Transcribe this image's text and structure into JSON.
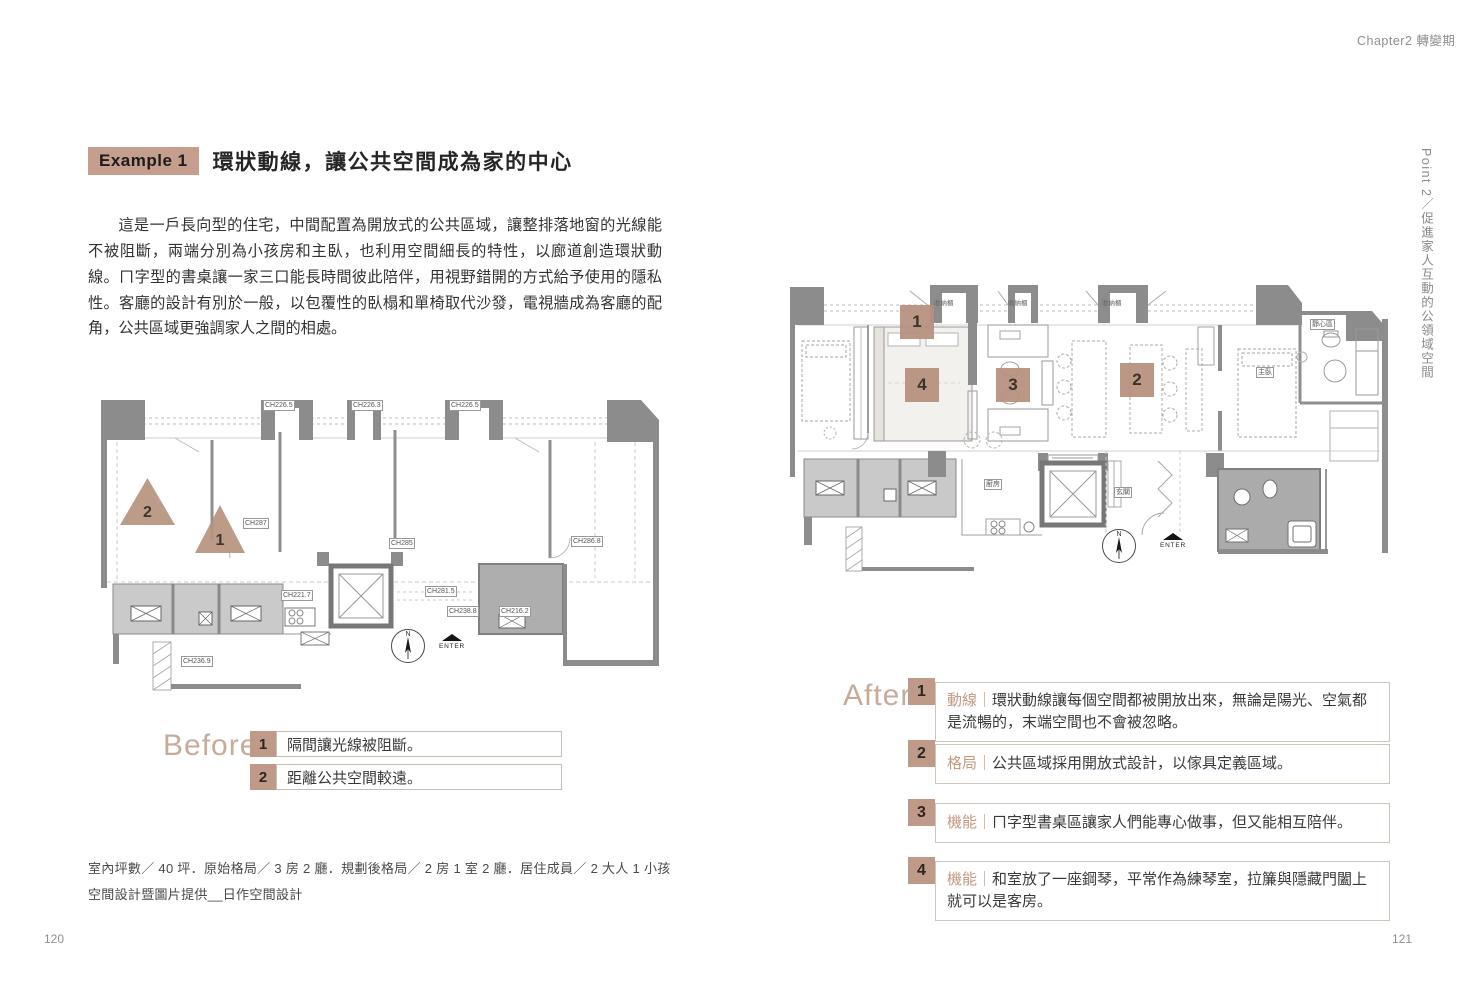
{
  "meta": {
    "chapter": "Chapter2 轉變期",
    "part_note": "Point 2／促進家人互動的公領域空間",
    "page_left": "120",
    "page_right": "121"
  },
  "example": {
    "badge": "Example 1",
    "title": "環狀動線，讓公共空間成為家的中心",
    "body": "這是一戶長向型的住宅，中間配置為開放式的公共區域，讓整排落地窗的光線能不被阻斷，兩端分別為小孩房和主臥，也利用空間細長的特性，以廊道創造環狀動線。ㄇ字型的書桌讓一家三口能長時間彼此陪伴，用視野錯開的方式給予使用的隱私性。客廳的設計有別於一般，以包覆性的臥榻和單椅取代沙發，電視牆成為客廳的配角，公共區域更強調家人之間的相處。"
  },
  "before": {
    "label": "Before",
    "items": [
      {
        "num": "1",
        "text": "隔間讓光線被阻斷。"
      },
      {
        "num": "2",
        "text": "距離公共空間較遠。"
      }
    ]
  },
  "after": {
    "label": "After",
    "separator": "｜",
    "items": [
      {
        "num": "1",
        "category": "動線",
        "text": "環狀動線讓每個空間都被開放出來，無論是陽光、空氣都是流暢的，末端空間也不會被忽略。"
      },
      {
        "num": "2",
        "category": "格局",
        "text": "公共區域採用開放式設計，以傢具定義區域。"
      },
      {
        "num": "3",
        "category": "機能",
        "text": "ㄇ字型書桌區讓家人們能專心做事，但又能相互陪伴。"
      },
      {
        "num": "4",
        "category": "機能",
        "text": "和室放了一座鋼琴，平常作為練琴室，拉簾與隱藏門闔上就可以是客房。"
      }
    ]
  },
  "footer": {
    "line1": "室內坪數／ 40 坪．原始格局／ 3 房 2 廳．規劃後格局／ 2 房 1 室 2 廳．居住成員／ 2 大人 1 小孩",
    "line2": "空間設計暨圖片提供__日作空間設計"
  },
  "plan_before": {
    "markers": [
      "1",
      "2"
    ],
    "compass_n": "N",
    "enter": "ENTER",
    "annotations": [
      "CH226.5",
      "CH226.3",
      "CH226.5",
      "CH287",
      "CH285",
      "CH286.8",
      "CH221.7",
      "CH236.9",
      "CH281.5",
      "CH238.8",
      "CH216.2"
    ]
  },
  "plan_after": {
    "markers": [
      "1",
      "2",
      "3",
      "4"
    ],
    "compass_n": "N",
    "enter": "ENTER",
    "annotations": [
      "收納櫃",
      "收納櫃",
      "收納櫃",
      "廚房",
      "玄關",
      "靜心區",
      "主臥"
    ]
  },
  "colors": {
    "accent_tan": "#bf9a88",
    "badge_bg": "#c59e8d",
    "heading_word": "#c7ab9a",
    "wall_gray": "#8c8c8c"
  }
}
